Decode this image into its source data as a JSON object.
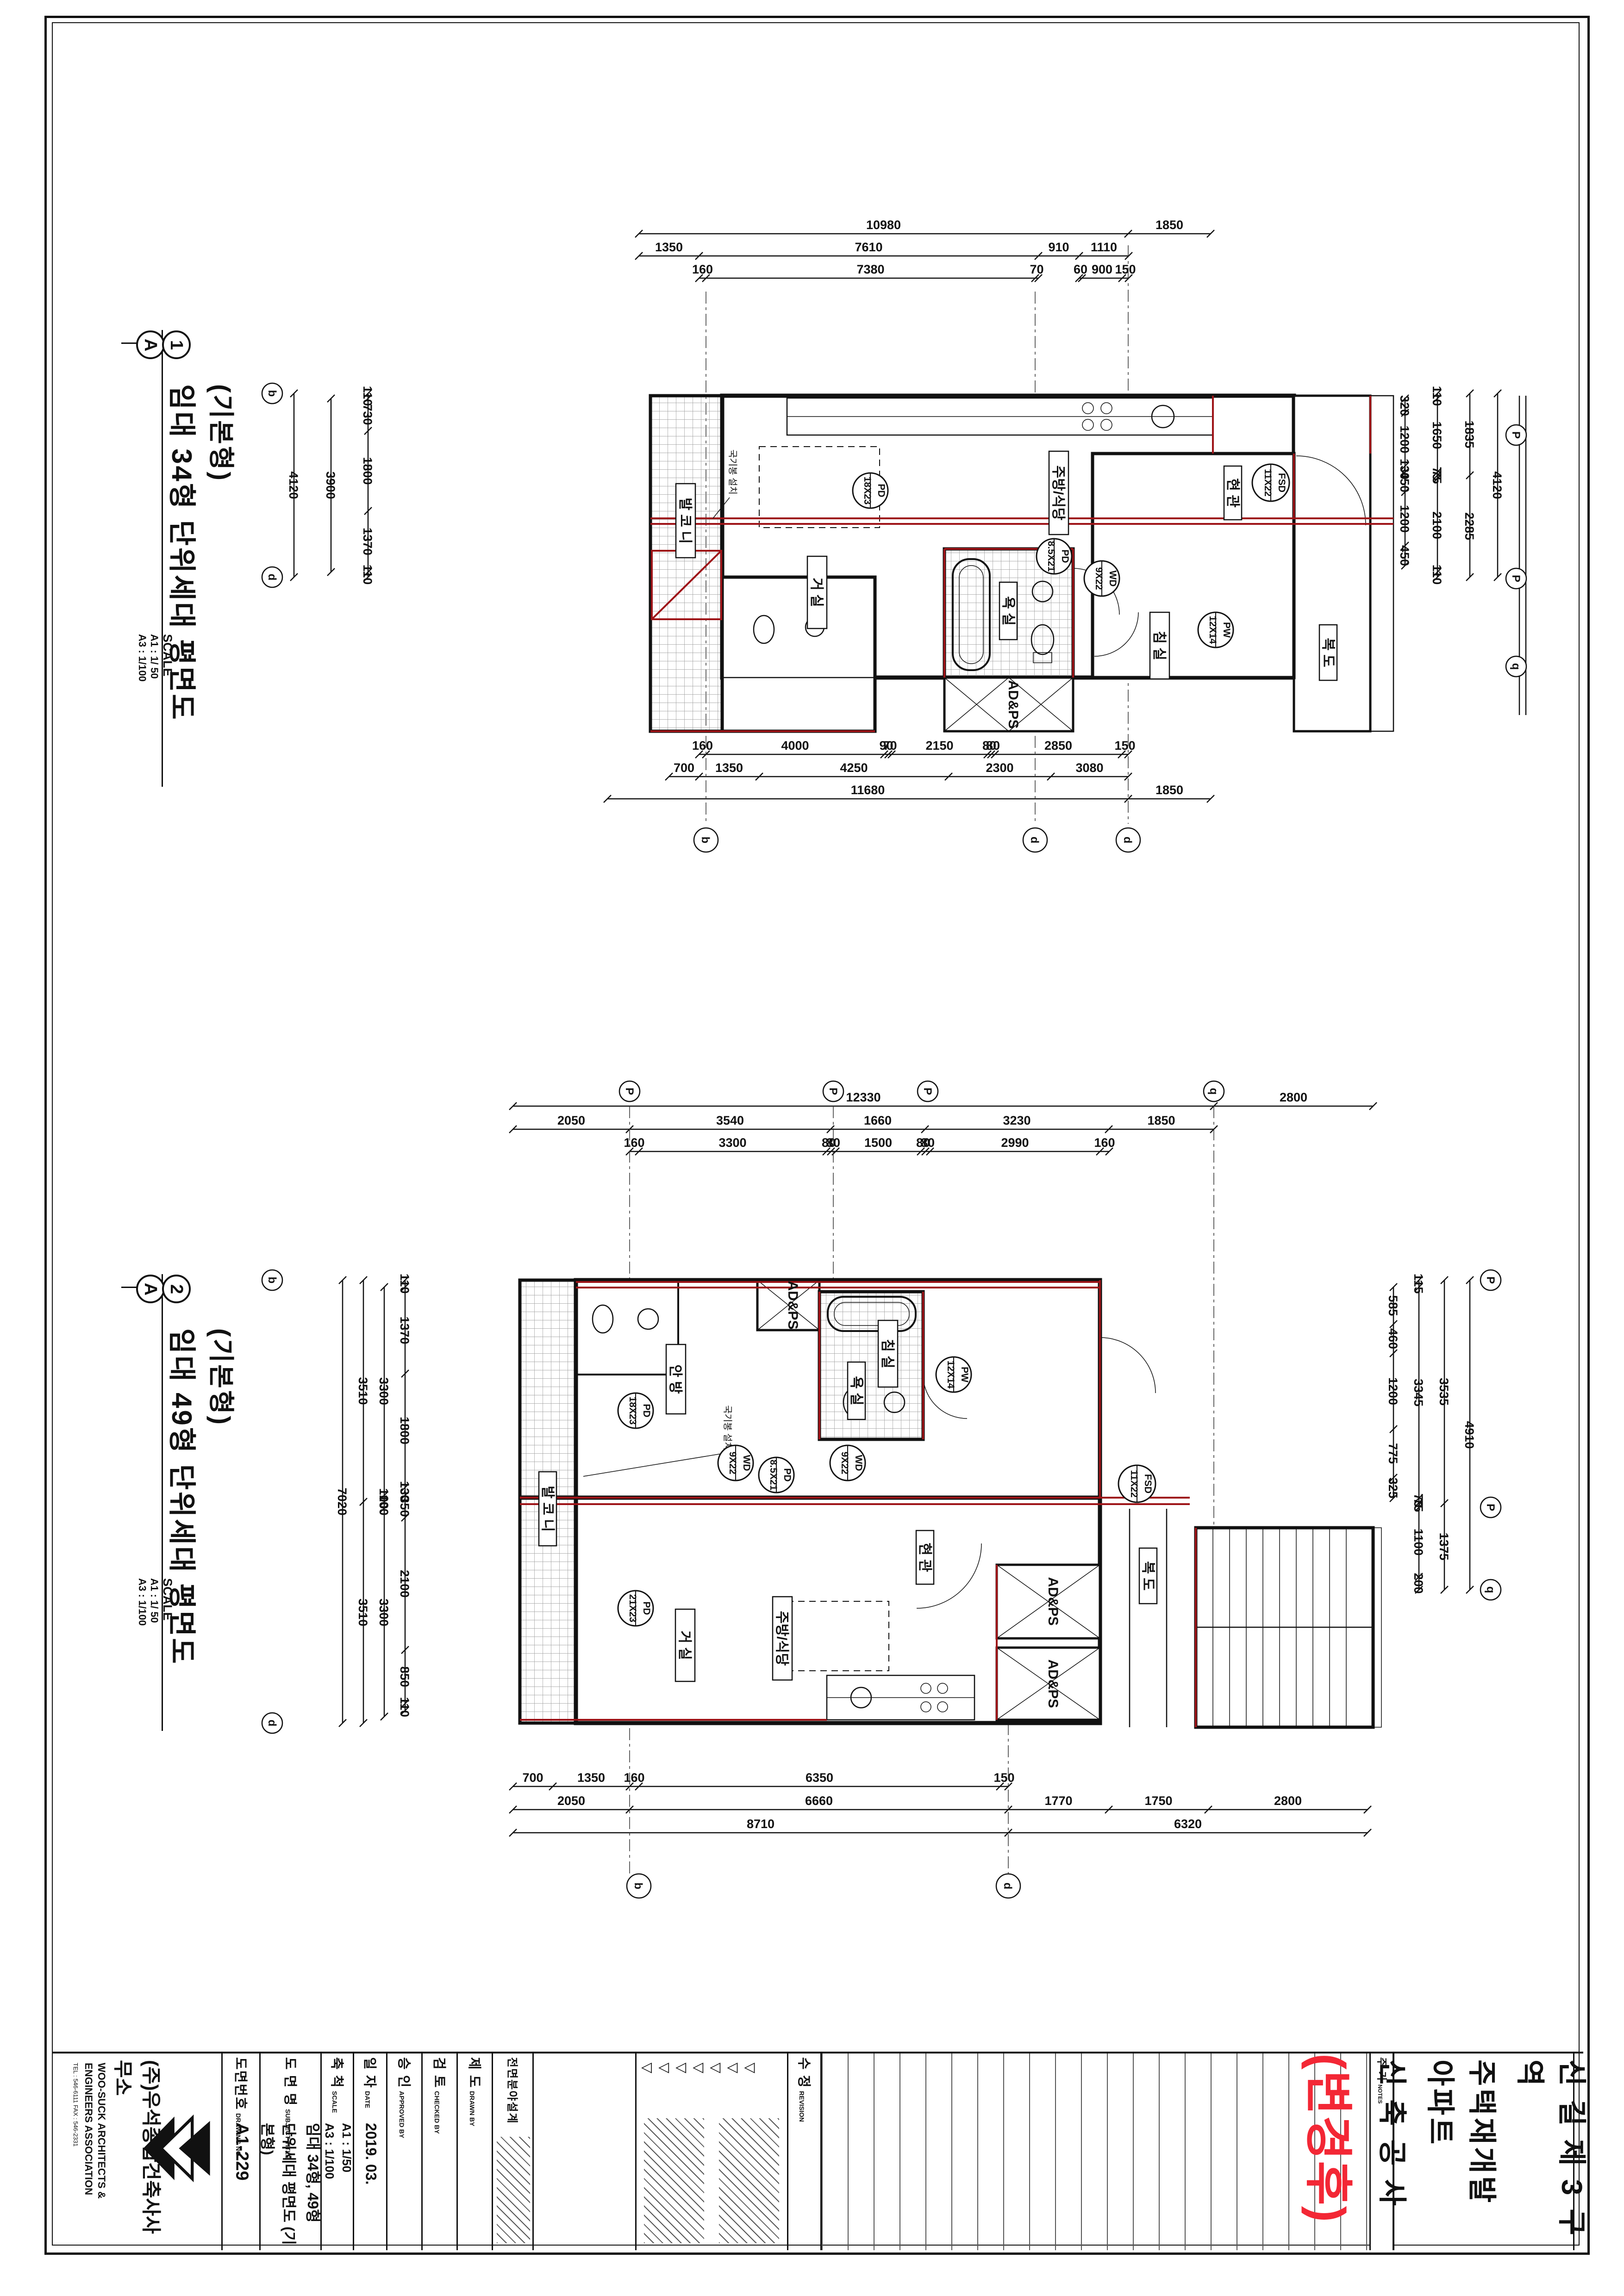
{
  "colors": {
    "line": "#111111",
    "red_accent": "#9e1418",
    "stamp_red": "#f32735",
    "paper": "#ffffff"
  },
  "plan1": {
    "marker": {
      "section_letter": "A",
      "detail_number": "1"
    },
    "title_line1": "(기본형)",
    "title_line2": "임대 34형 단위세대 평면도",
    "scale_label": "SCALE",
    "scale_a1": "A1 : 1/ 50",
    "scale_a3": "A3 : 1/100",
    "dims": {
      "t1": [
        "10980",
        "1850"
      ],
      "t2": [
        "1350",
        "7610",
        "910",
        "1110"
      ],
      "t3": [
        "160",
        "7380",
        "70"
      ],
      "t3b": [
        "60",
        "900",
        "150"
      ],
      "b1": [
        "160",
        "4000",
        "90",
        "70",
        "2150",
        "80",
        "80",
        "2850",
        "150"
      ],
      "b2": [
        "700",
        "1350",
        "4250",
        "2300",
        "3080"
      ],
      "b3": [
        "11680",
        "1850"
      ],
      "l1": [
        "110",
        "730",
        "1800",
        "1370",
        "110"
      ],
      "l2": [
        "3900"
      ],
      "l3": [
        "4120"
      ],
      "r1": [
        "320",
        "1200",
        "130",
        "450",
        "1200",
        "450"
      ],
      "r2": [
        "110",
        "1650",
        "75",
        "75",
        "2100",
        "110"
      ],
      "r3": [
        "1835",
        "2285"
      ],
      "r4": [
        "4120"
      ]
    },
    "rooms": {
      "balcony": "발 코 니",
      "living": "거 실",
      "bed": "침 실",
      "bath": "욕 실",
      "kitchen": "주방/식당",
      "entry": "현 관",
      "corridor": "복 도"
    },
    "shaft_label": "AD&PS",
    "note_flagpole": "국기봉 설치",
    "tags": [
      {
        "size": "18X23",
        "code": "PD"
      },
      {
        "size": "8.5X21",
        "code": "PD"
      },
      {
        "size": "9X22",
        "code": "WD"
      },
      {
        "size": "12X14",
        "code": "PW"
      },
      {
        "size": "11X22",
        "code": "FSD"
      }
    ],
    "grid_letters": {
      "left_top": "b",
      "left_bottom": "d",
      "right": [
        "P",
        "P",
        "q"
      ],
      "bottom": [
        "b",
        "d",
        "d"
      ]
    }
  },
  "plan2": {
    "marker": {
      "section_letter": "A",
      "detail_number": "2"
    },
    "title_line1": "(기본형)",
    "title_line2": "임대 49형 단위세대 평면도",
    "scale_label": "SCALE",
    "scale_a1": "A1 : 1/ 50",
    "scale_a3": "A3 : 1/100",
    "dims": {
      "t1": [
        "12330",
        "2800"
      ],
      "t2": [
        "2050",
        "3540",
        "1660",
        "3230",
        "1850"
      ],
      "t3": [
        "160",
        "3300",
        "80",
        "80",
        "1500",
        "80",
        "80",
        "2990",
        "160"
      ],
      "b1": [
        "700",
        "1350",
        "160",
        "6350",
        "150"
      ],
      "b2": [
        "2050",
        "6660",
        "1770",
        "1750",
        "2800"
      ],
      "b3": [
        "8710",
        "6320"
      ],
      "l1": [
        "110",
        "1370",
        "1800",
        "130",
        "350",
        "2100",
        "850",
        "110"
      ],
      "l2": [
        "3300",
        "100",
        "100",
        "3300"
      ],
      "l3": [
        "3510",
        "3510"
      ],
      "l4": [
        "7020"
      ],
      "r1": [
        "585",
        "460",
        "1200",
        "775",
        "325"
      ],
      "r2": [
        "115",
        "3345",
        "75",
        "75",
        "1100",
        "200"
      ],
      "r3": [
        "3535",
        "1375"
      ],
      "r4": [
        "4910"
      ]
    },
    "rooms": {
      "balcony": "발 코 니",
      "master": "안 방",
      "living": "거 실",
      "bed": "침 실",
      "bath": "욕 실",
      "kitchen": "주방/식당",
      "entry": "현 관",
      "corridor": "복 도"
    },
    "shaft_label": "AD&PS",
    "note_flagpole": "국기봉 설치",
    "tags": [
      {
        "size": "18X23",
        "code": "PD"
      },
      {
        "size": "9X22",
        "code": "WD"
      },
      {
        "size": "8.5X21",
        "code": "PD"
      },
      {
        "size": "9X22",
        "code": "WD"
      },
      {
        "size": "12X14",
        "code": "PW"
      },
      {
        "size": "11X22",
        "code": "FSD"
      },
      {
        "size": "21X23",
        "code": "PD"
      }
    ],
    "grid_letters": {
      "top": [
        "P",
        "P",
        "P",
        "q"
      ],
      "bottom": [
        "b",
        "d"
      ],
      "left_top": "b",
      "left_bottom": "d",
      "right": [
        "P",
        "P",
        "q"
      ]
    }
  },
  "titleblock": {
    "company": {
      "name": "(주)우석종합건축사사무소",
      "eng1": "WOO-SUCK ARCHITECTS &",
      "eng2": "ENGINEERS ASSOCIATION",
      "tel": "TEL : 546-6111  FAX : 546-2331"
    },
    "fields": [
      {
        "kor": "도면번호",
        "eng": "DRAWING NO",
        "value": "A1-229",
        "value2": ""
      },
      {
        "kor": "도 면 명",
        "eng": "SUBJECT TITLE",
        "value": "임대 34형, 49형",
        "value2": "단위세대 평면도 (기본형)"
      },
      {
        "kor": "축 척",
        "eng": "SCALE",
        "value": "A1 : 1/50",
        "value2": "A3 : 1/100"
      },
      {
        "kor": "일 자",
        "eng": "DATE",
        "value": "2019. 03.",
        "value2": ""
      },
      {
        "kor": "승 인",
        "eng": "APPROVED BY",
        "value": "",
        "value2": ""
      },
      {
        "kor": "검 토",
        "eng": "CHECKED BY",
        "value": "",
        "value2": ""
      },
      {
        "kor": "제 도",
        "eng": "DRAWN BY",
        "value": "",
        "value2": ""
      }
    ],
    "discipline": "전면분야설계",
    "revision": {
      "kor": "수 정",
      "eng": "REVISION"
    },
    "rev_triangles": "◁◁◁◁◁◁◁",
    "note": {
      "kor": "주 기",
      "eng": "NOTES"
    },
    "stamp": "(변경후)",
    "project_line1": "신 길   제 3 구 역",
    "project_line2": "주택재개발 아파트",
    "project_line3": "신 축 공 사"
  }
}
